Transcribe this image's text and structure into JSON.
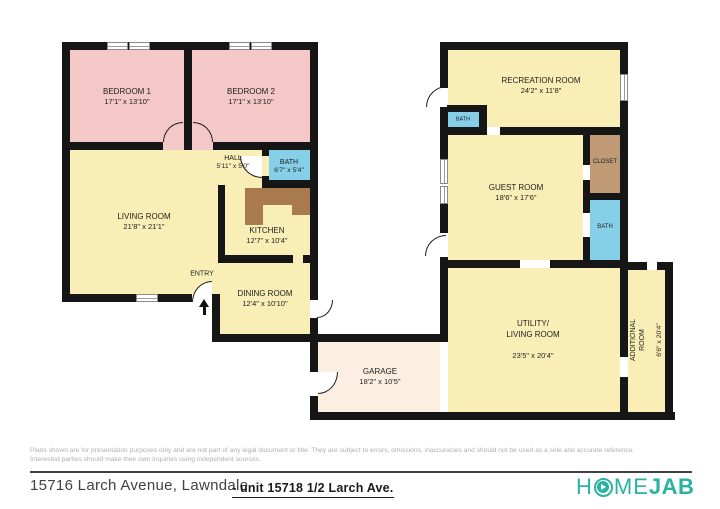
{
  "plan": {
    "rooms": {
      "bedroom1": {
        "name": "BEDROOM 1",
        "dims": "17'1\" x 13'10\""
      },
      "bedroom2": {
        "name": "BEDROOM 2",
        "dims": "17'1\" x 13'10\""
      },
      "hall": {
        "name": "HALL",
        "dims": "5'11\" x 5'0\""
      },
      "bath_main": {
        "name": "BATH",
        "dims": "6'7\" x 5'4\""
      },
      "living": {
        "name": "LIVING ROOM",
        "dims": "21'8\" x 21'1\""
      },
      "kitchen": {
        "name": "KITCHEN",
        "dims": "12'7\" x 10'4\""
      },
      "entry": {
        "name": "ENTRY"
      },
      "dining": {
        "name": "DINING ROOM",
        "dims": "12'4\" x 10'10\""
      },
      "garage": {
        "name": "GARAGE",
        "dims": "18'2\" x 10'5\""
      },
      "recreation": {
        "name": "RECREATION ROOM",
        "dims": "24'2\" x 11'8\""
      },
      "bath_recreation": {
        "name": "BATH"
      },
      "guest": {
        "name": "GUEST ROOM",
        "dims": "18'6\" x 17'6\""
      },
      "closet": {
        "name": "CLOSET"
      },
      "bath_guest": {
        "name": "BATH"
      },
      "utility": {
        "name": "UTILITY/\nLIVING ROOM",
        "dims": "23'5\" x 20'4\""
      },
      "additional": {
        "name": "ADDITIONAL\nROOM",
        "dims": "6'6\" x 20'4\""
      }
    }
  },
  "footer": {
    "disclaimer": "Plans shown are for presentation purposes only and are not part of any legal document or title. They are subject to errors, omissions, inaccuracies and should not be used as a sole and accurate reference.\nInterested parties should make their own inquiries using independent sources.",
    "address": "15716 Larch Avenue, Lawndale",
    "unit_label": "- unit 15718 1/2  Larch Ave.",
    "logo": {
      "part1": "H",
      "part2": "ME",
      "part3": "JAB",
      "play_icon": "play-button"
    }
  },
  "colors": {
    "bedroom_pink": "#f4c8c7",
    "room_yellow": "#f9eeb6",
    "bath_blue": "#85cfe9",
    "closet_tan": "#c09a74",
    "counter_brown": "#aa7a4f",
    "garage_peach": "#fbefe2",
    "wall_black": "#161616",
    "brand_teal": "#2bb3a2"
  }
}
